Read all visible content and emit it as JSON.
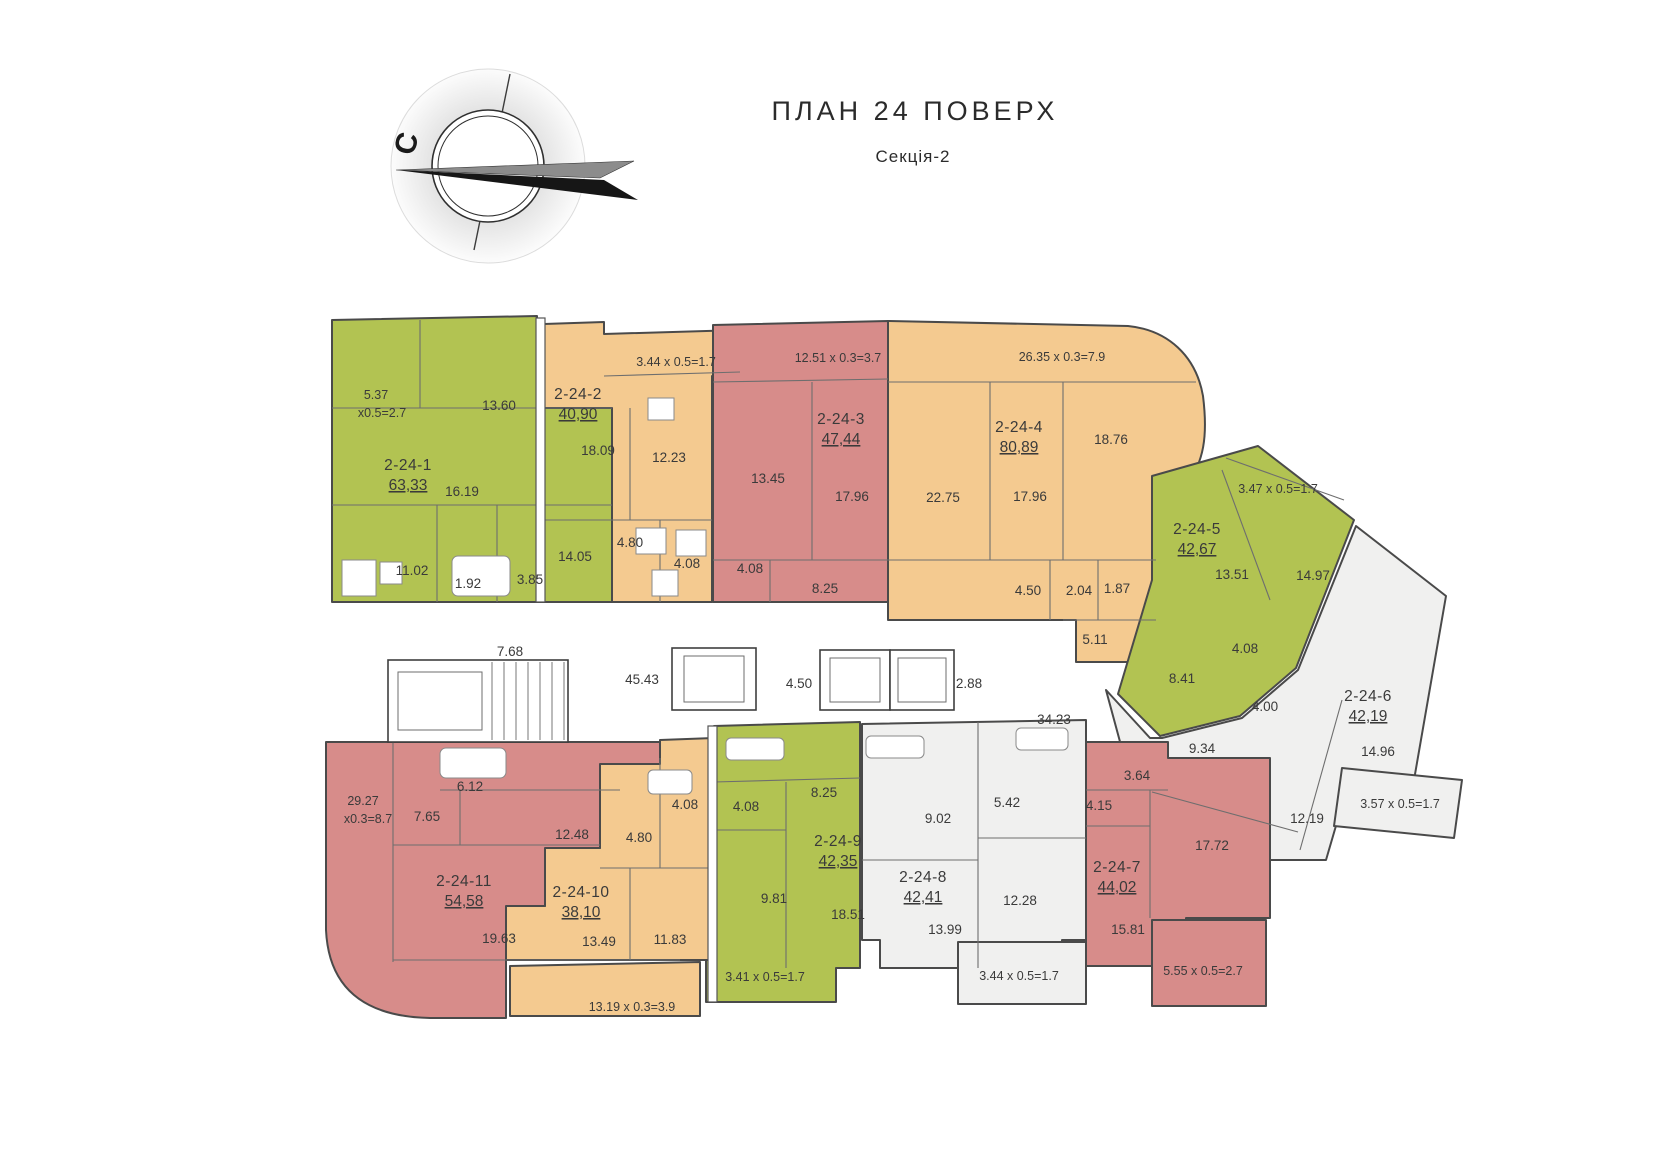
{
  "header": {
    "title": "ПЛАН 24 ПОВЕРХ",
    "subtitle": "Секція-2"
  },
  "compass": {
    "north_label": "С"
  },
  "palette": {
    "green": "#b2c352",
    "orange": "#f4ca90",
    "red": "#d78c8a",
    "white_room": "#f0f0ef",
    "wall": "#4a4a4a"
  },
  "apartments": [
    {
      "id": "2-24-1",
      "area": "63,33",
      "color": "green",
      "rooms": [
        "13.60",
        "16.19",
        "11.02",
        "1.92",
        "3.85",
        "14.05"
      ],
      "balcony": [
        "5.37",
        "x0.5=2.7"
      ]
    },
    {
      "id": "2-24-2",
      "area": "40,90",
      "color": "orange",
      "rooms": [
        "18.09",
        "12.23",
        "4.80",
        "4.08"
      ],
      "balcony": [
        "3.44 x 0.5=1.7"
      ]
    },
    {
      "id": "2-24-3",
      "area": "47,44",
      "color": "red",
      "rooms": [
        "13.45",
        "17.96",
        "4.08",
        "8.25"
      ],
      "balcony": [
        "12.51 x 0.3=3.7"
      ]
    },
    {
      "id": "2-24-4",
      "area": "80,89",
      "color": "orange",
      "rooms": [
        "22.75",
        "17.96",
        "18.76",
        "4.50",
        "2.04",
        "1.87",
        "5.11"
      ],
      "balcony": [
        "26.35 x 0.3=7.9"
      ]
    },
    {
      "id": "2-24-5",
      "area": "42,67",
      "color": "green",
      "rooms": [
        "13.51",
        "14.97",
        "4.08",
        "8.41"
      ],
      "balcony": [
        "3.47 x 0.5=1.7"
      ]
    },
    {
      "id": "2-24-6",
      "area": "42,19",
      "color": "white_room",
      "rooms": [
        "4.00",
        "9.34",
        "14.96",
        "12.19"
      ],
      "balcony": [
        "3.57 x 0.5=1.7"
      ]
    },
    {
      "id": "2-24-7",
      "area": "44,02",
      "color": "red",
      "rooms": [
        "3.64",
        "4.15",
        "17.72",
        "15.81"
      ],
      "balcony": [
        "5.55 x 0.5=2.7"
      ]
    },
    {
      "id": "2-24-8",
      "area": "42,41",
      "color": "white_room",
      "rooms": [
        "9.02",
        "5.42",
        "12.28",
        "13.99"
      ],
      "balcony": [
        "3.44 x 0.5=1.7"
      ]
    },
    {
      "id": "2-24-9",
      "area": "42,35",
      "color": "green",
      "rooms": [
        "8.25",
        "4.08",
        "9.81",
        "18.51"
      ],
      "balcony": [
        "3.41 x 0.5=1.7"
      ]
    },
    {
      "id": "2-24-10",
      "area": "38,10",
      "color": "orange",
      "rooms": [
        "4.08",
        "4.80",
        "13.49",
        "11.83"
      ],
      "balcony": [
        "13.19 x 0.3=3.9"
      ]
    },
    {
      "id": "2-24-11",
      "area": "54,58",
      "color": "red",
      "rooms": [
        "6.12",
        "7.65",
        "12.48",
        "19.63"
      ],
      "balcony": [
        "29.27",
        "x0.3=8.7"
      ]
    }
  ],
  "common_areas": {
    "corridor_small": "7.68",
    "corridor_main": "45.43",
    "lift_lobby": "4.50",
    "lift_shaft": "2.88",
    "corridor_right": "34.23"
  }
}
